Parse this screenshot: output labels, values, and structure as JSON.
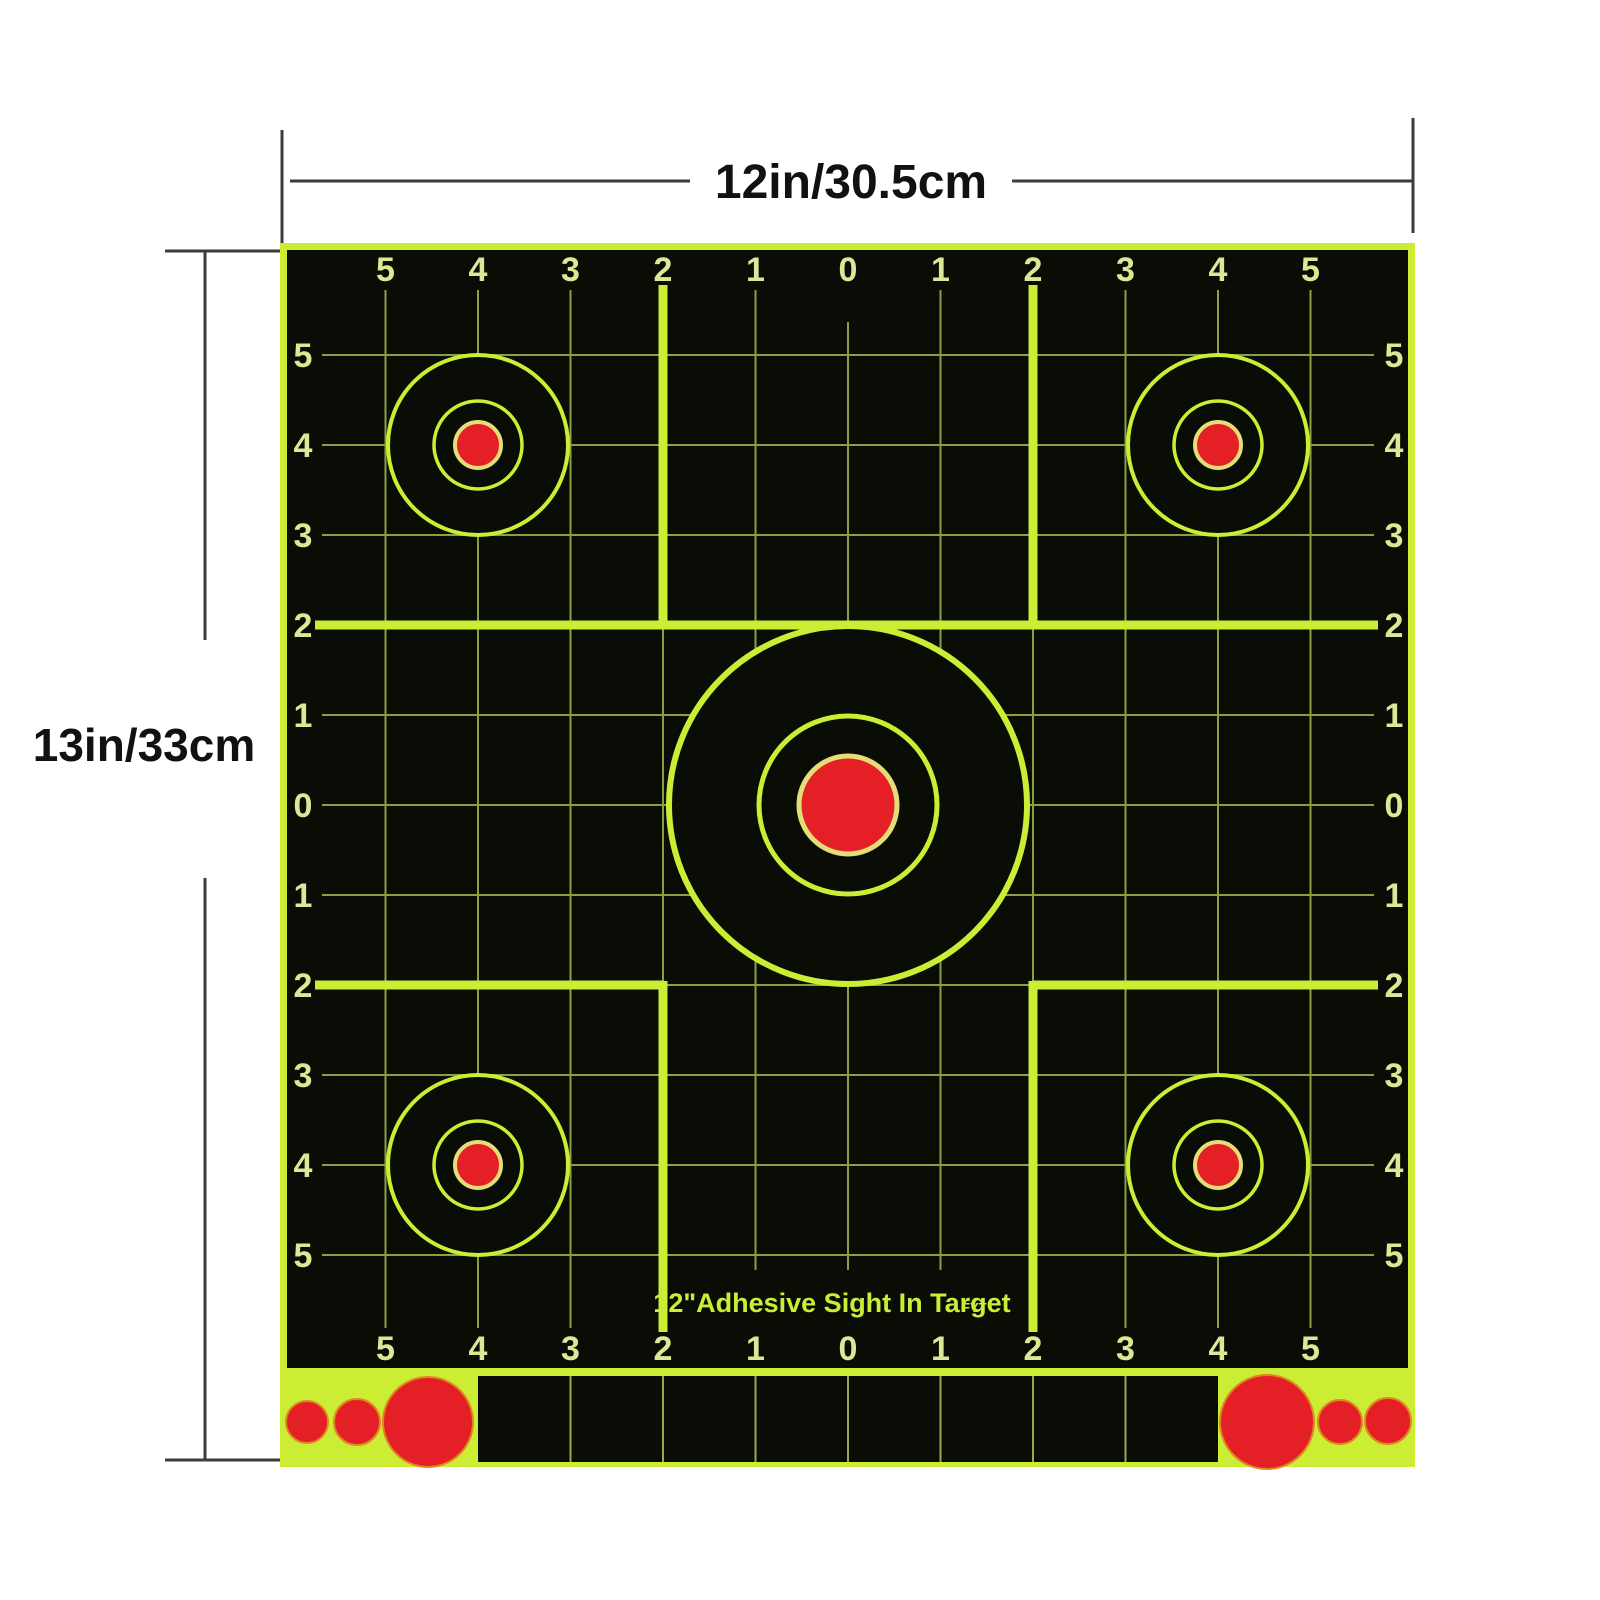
{
  "dimensions": {
    "width_label": "12in/30.5cm",
    "height_label": "13in/33cm"
  },
  "target": {
    "title": "12\"Adhesive Sight In Target",
    "brand": "FYT",
    "scale_top": [
      "5",
      "4",
      "3",
      "2",
      "1",
      "0",
      "1",
      "2",
      "3",
      "4",
      "5"
    ],
    "scale_bottom": [
      "5",
      "4",
      "3",
      "2",
      "1",
      "0",
      "1",
      "2",
      "3",
      "4",
      "5"
    ],
    "scale_left": [
      "5",
      "4",
      "3",
      "2",
      "1",
      "0",
      "1",
      "2",
      "3",
      "4",
      "5"
    ],
    "scale_right": [
      "5",
      "4",
      "3",
      "2",
      "1",
      "0",
      "1",
      "2",
      "3",
      "4",
      "5"
    ]
  },
  "colors": {
    "lime": "#cbee35",
    "grid": "#8f9e42",
    "label": "#dce896",
    "black": "#0a0c06",
    "red": "#e42026",
    "ring": "#e5dd77",
    "strip_sep": "#98a74e",
    "dot_edge": "#e0871f",
    "dim": "#3c3c3c",
    "text": "#111111",
    "paper": "#ffffff"
  }
}
